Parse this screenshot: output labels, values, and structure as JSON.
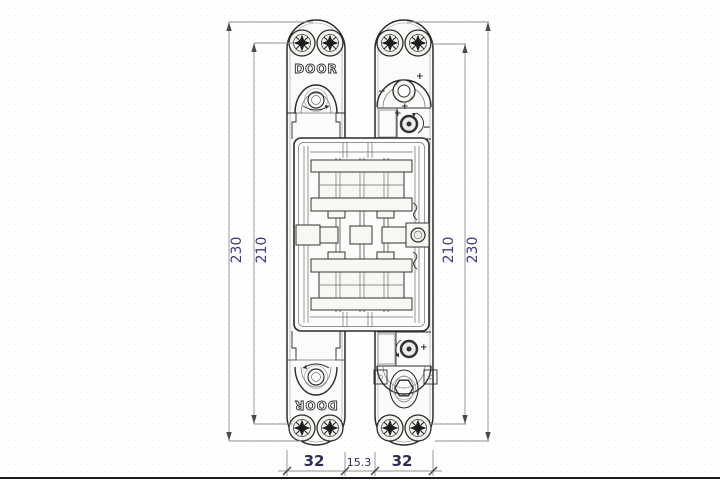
{
  "drawing": {
    "type": "technical-drawing",
    "subject": "concealed-door-hinge-front-elevation",
    "labels": {
      "door_top": "DOOR",
      "door_bottom": "DOOR"
    },
    "dimensions": {
      "left_outer": "230",
      "left_inner": "210",
      "right_inner": "210",
      "right_outer": "230",
      "bottom_left": "32",
      "bottom_middle": "15.3",
      "bottom_right": "32"
    },
    "adjusters": {
      "plus": "+",
      "minus": "−"
    },
    "colors": {
      "line": "#2b2b2b",
      "dimension_line": "#8f8f8f",
      "dimension_text_side": "#3e3a85",
      "dimension_text_bottom": "#2c2c55",
      "background": "#ffffff"
    }
  }
}
